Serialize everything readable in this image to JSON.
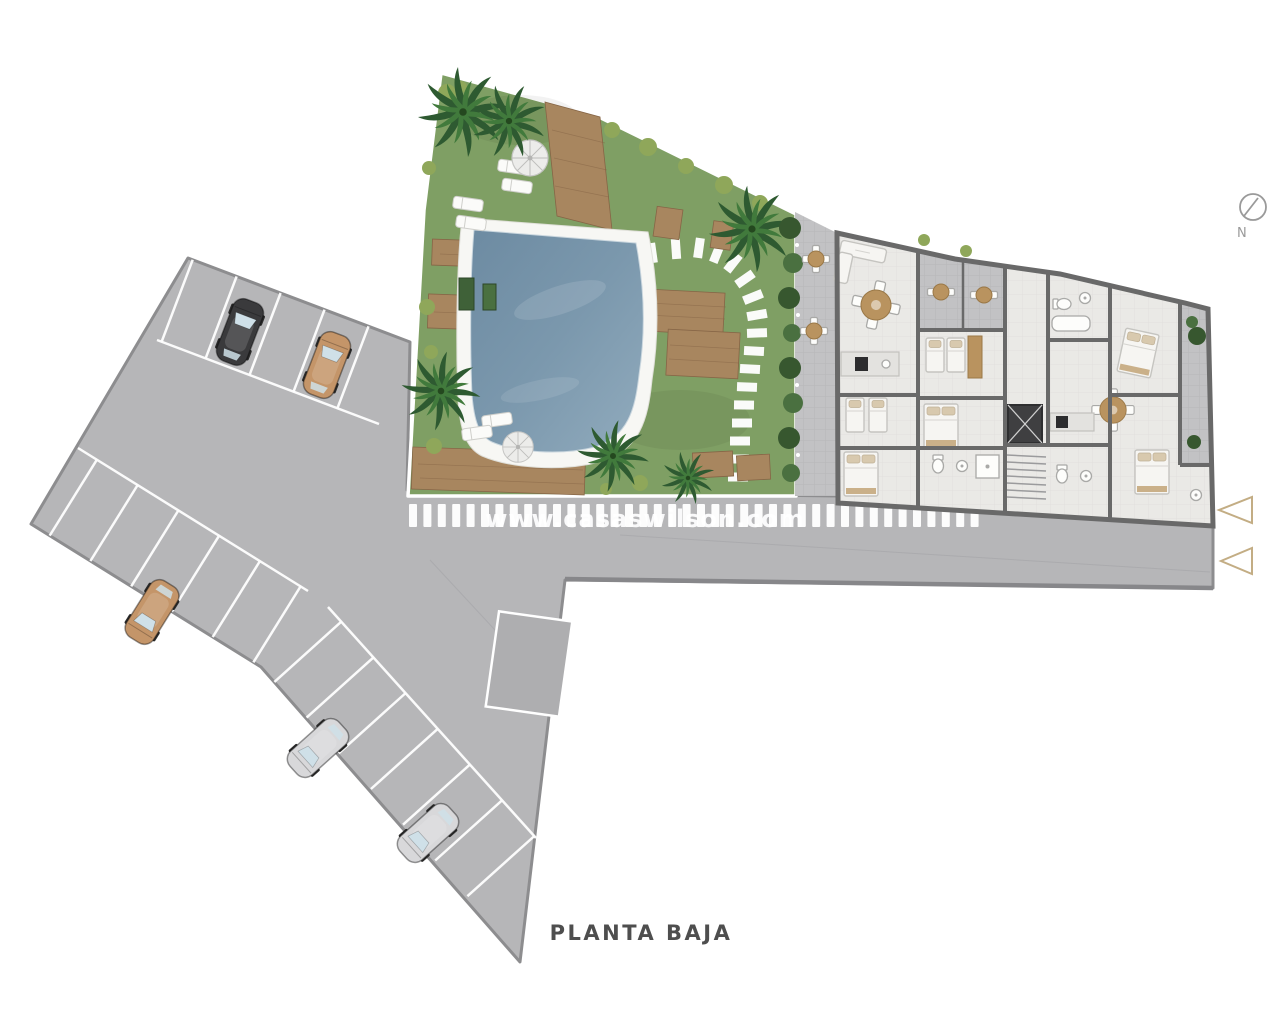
{
  "title": {
    "text": "PLANTA BAJA"
  },
  "watermark": {
    "text": "www.casaswilson.com"
  },
  "compass": {
    "label": "N"
  },
  "colors": {
    "paving": "#b6b6b8",
    "paving_edge": "#8d8d8f",
    "stripe": "#ffffff",
    "grass": "#7f9f64",
    "pool_water": "#7b98ad",
    "pool_deck": "#f7f7f4",
    "wood": "#a8865f",
    "wood_dark": "#866546",
    "wall": "#696969",
    "floor": "#eae9e6",
    "terrace": "#c2c2c4",
    "palm": "#2e5a31",
    "palm_light": "#417a3c",
    "hedge": "#37572f",
    "bush": "#8fa75a",
    "furn_white": "#f6f5f2",
    "furn_tan": "#b9935f",
    "car_black": "#3a3a3c",
    "car_tan": "#c49569",
    "car_silver": "#d8d8da",
    "arrow": "#c3ad84",
    "title": "#4e4e4e",
    "compass": "#9a9a9a"
  }
}
